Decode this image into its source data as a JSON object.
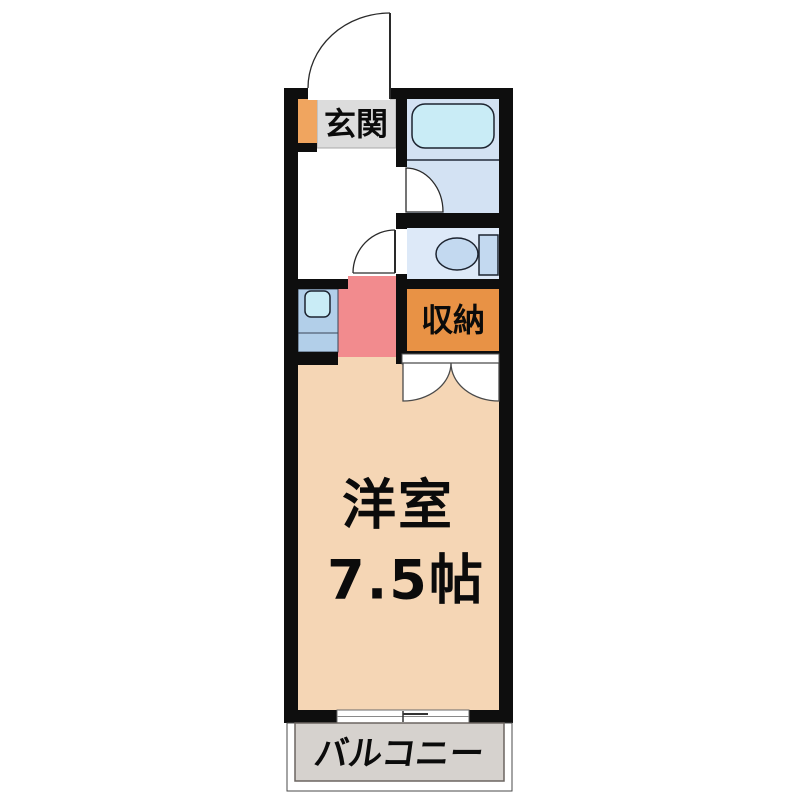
{
  "floor_plan": {
    "rooms": {
      "entrance": {
        "label": "玄関"
      },
      "storage": {
        "label": "収納"
      },
      "western_room": {
        "name": "洋室",
        "size": "7.5帖"
      },
      "balcony": {
        "label": "バルコニー"
      }
    },
    "fixtures": [
      "bathtub",
      "toilet",
      "kitchen-sink",
      "shoe-cabinet",
      "sliding-window",
      "hinged-doors"
    ]
  },
  "colors": {
    "wall": "#0e0e0e",
    "main_room": "#f5d6b5",
    "kitchen_floor": "#f28b8e",
    "closet": "#e89245",
    "shoe_cabinet": "#f0a55f",
    "entrance_floor": "#dcdcdc",
    "bathroom": "#d3e2f3",
    "bathtub": "#c9ecf6",
    "toilet_room": "#dde9f8",
    "toilet_fixture": "#c3d9f0",
    "kitchen_unit": "#b2cfe9",
    "kitchen_sink": "#c9ecf6",
    "balcony": "#d6d2ce"
  }
}
